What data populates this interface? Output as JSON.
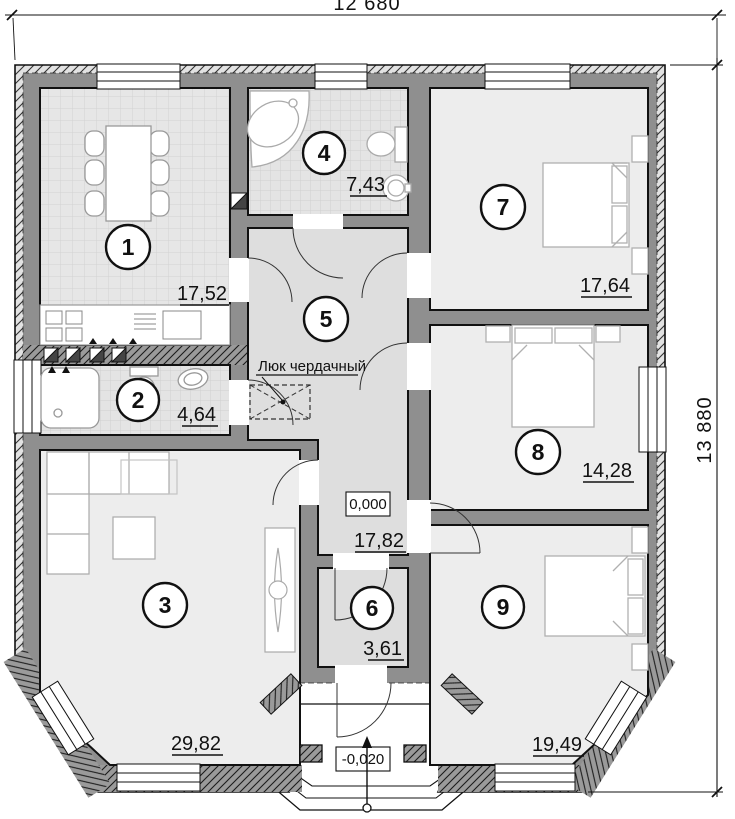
{
  "plan": {
    "dimensions": {
      "width_label": "12 680",
      "height_label": "13 880"
    },
    "rooms": [
      {
        "number": "1",
        "area": "17,52"
      },
      {
        "number": "2",
        "area": "4,64"
      },
      {
        "number": "3",
        "area": "29,82"
      },
      {
        "number": "4",
        "area": "7,43"
      },
      {
        "number": "5",
        "area": "17,82"
      },
      {
        "number": "6",
        "area": "3,61"
      },
      {
        "number": "7",
        "area": "17,64"
      },
      {
        "number": "8",
        "area": "14,28"
      },
      {
        "number": "9",
        "area": "19,49"
      }
    ],
    "annotations": {
      "attic_hatch_label": "Люк чердачный",
      "level_main": "0,000",
      "level_porch": "-0,020"
    },
    "colors": {
      "wall": "#8f8f8f",
      "floor_light": "#ededed",
      "floor_tile": "#e6e6e6",
      "hall_floor": "#dedede",
      "line": "#111111"
    }
  }
}
